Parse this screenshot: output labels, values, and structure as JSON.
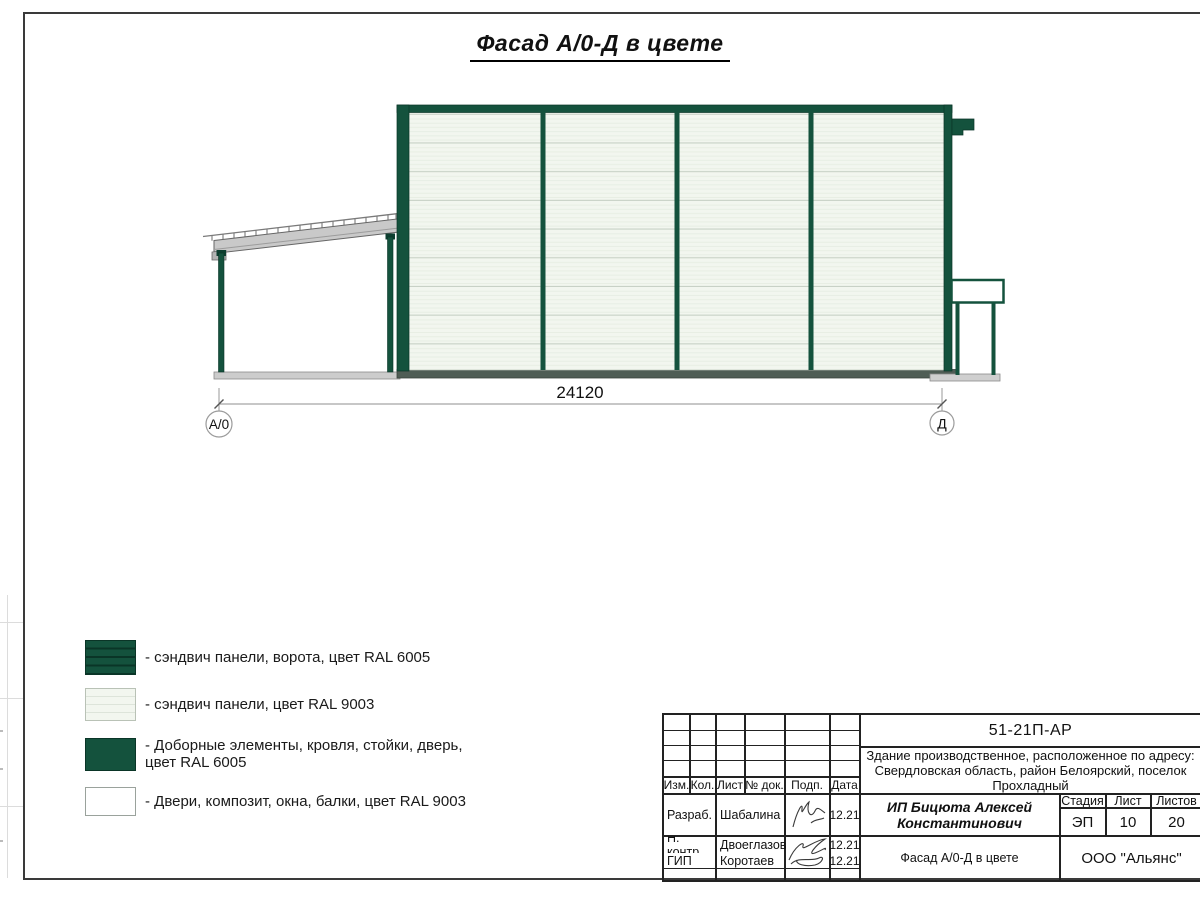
{
  "page": {
    "title": "Фасад А/0-Д в цвете"
  },
  "drawing": {
    "dimension_label": "24120",
    "axis_left_label": "А/0",
    "axis_right_label": "Д"
  },
  "legend": {
    "items": [
      {
        "name": "sandwich-panels-gate",
        "label": "- сэндвич панели, ворота, цвет RAL 6005"
      },
      {
        "name": "sandwich-panels-wall",
        "label": "- сэндвич панели, цвет RAL 9003"
      },
      {
        "name": "trim-roof-posts-door",
        "label": "- Доборные элементы, кровля, стойки, дверь,",
        "label2": "цвет RAL 6005"
      },
      {
        "name": "doors-composite-windows-beams",
        "label": "- Двери, композит, окна, балки, цвет RAL 9003"
      }
    ]
  },
  "title_block": {
    "doc_number": "51-21П-АР",
    "address": {
      "line1": "Здание производственное, расположенное по адресу:",
      "line2": "Свердловская область, район Белоярский, поселок",
      "line3": "Прохладный"
    },
    "columns": {
      "izm": "Изм.",
      "kol": "Кол.",
      "list": "Лист",
      "doc": "№ док.",
      "podp": "Подп.",
      "data": "Дата"
    },
    "signers": [
      {
        "role": "Разраб.",
        "name": "Шабалина",
        "date": "12.21"
      },
      {
        "role": "Н. контр.",
        "name": "Двоеглазов",
        "date": "12.21"
      },
      {
        "role": "ГИП",
        "name": "Коротаев",
        "date": "12.21"
      }
    ],
    "client_line1": "ИП Бицюта Алексей",
    "client_line2": "Константинович",
    "stage": {
      "label": "Стадия",
      "value": "ЭП"
    },
    "sheet": {
      "label": "Лист",
      "value": "10"
    },
    "sheets": {
      "label": "Листов",
      "value": "20"
    },
    "sheet_title": "Фасад А/0-Д в цвете",
    "company": "ООО \"Альянс\""
  },
  "colors": {
    "ral_6005_green": "#14523d",
    "ral_9003_white": "#f2f6ef",
    "steel_gray": "#c9c9c9"
  }
}
